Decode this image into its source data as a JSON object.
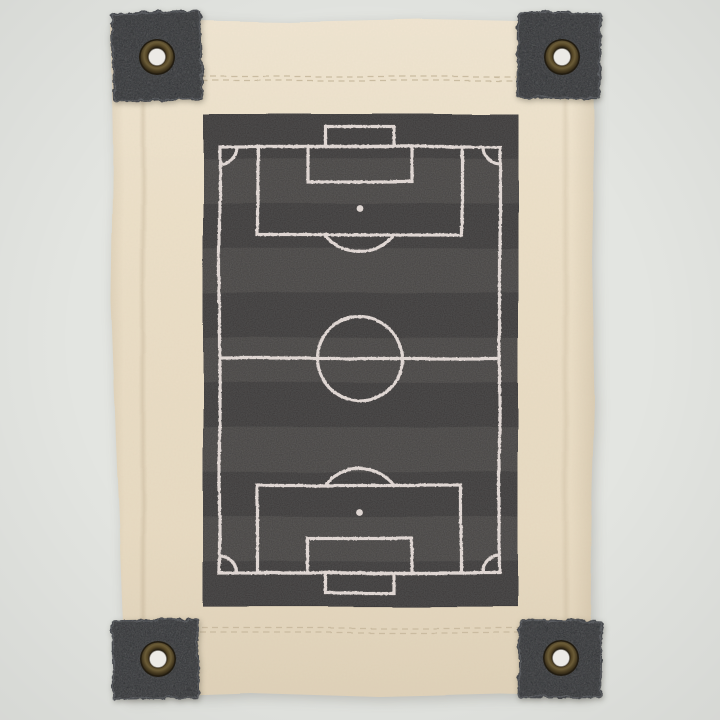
{
  "scene": {
    "type": "product-photo",
    "description": "Cream natural-canvas wall flag with four black denim corner tabs fixed by antique brass grommets, screen printed with a chalk-style soccer pitch diagram on a dark mowing-striped rectangle, photographed on a pale grey background",
    "labels": {
      "photo": "Canvas soccer pitch wall hanging",
      "banner": "Cream canvas banner",
      "print": "Soccer pitch print",
      "stitch_top": "Top hem stitching",
      "stitch_bottom": "Bottom hem stitching",
      "patch_tl": "Top left denim corner tab",
      "patch_tr": "Top right denim corner tab",
      "patch_bl": "Bottom left denim corner tab",
      "patch_br": "Bottom right denim corner tab",
      "grommet": "Antique brass grommet eyelet"
    }
  },
  "colors": {
    "background": "#e3e5e1",
    "canvas": "#ecdfc7",
    "canvas_shadow": "#d8c9ae",
    "stitch": "#c8b99e",
    "patch": "#2a2c2f",
    "grommet_ring": "#57492b",
    "grommet_rim": "#211b10",
    "grommet_hole": "#eceae6",
    "pitch_dark": "#3a3838",
    "pitch_light": "#464443",
    "pitch_line": "#e9dfdb"
  },
  "field_diagram": {
    "sport": "soccer",
    "stripe_count": 11,
    "elements": [
      "pitch-boundary",
      "halfway-line",
      "center-circle",
      "corner-arc",
      "penalty-area",
      "goal-area",
      "goal-box",
      "penalty-spot",
      "penalty-arc"
    ]
  }
}
